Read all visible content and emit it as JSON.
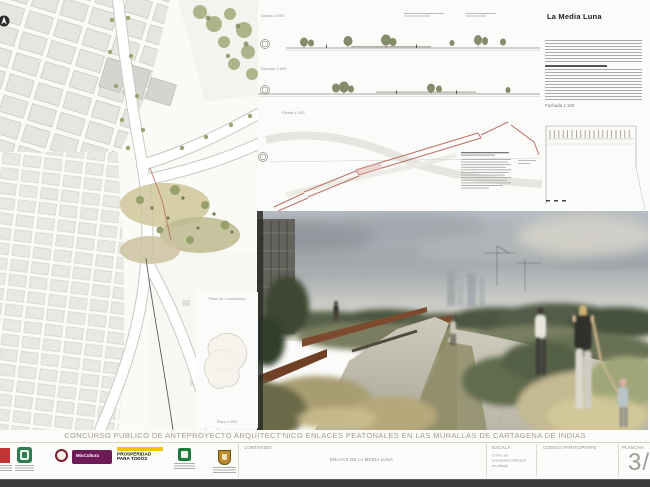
{
  "board": {
    "title": "CONCURSO PUBLICO DE ANTEPROYECTO ARQUITECT'NICO ENLACES PEATONALES EN LAS MURALLAS DE CARTAGENA DE INDIAS"
  },
  "memoria": {
    "heading": "La Media Luna",
    "drawing_label": "Fachada 1:100"
  },
  "drawings": {
    "section_top_label": "Alzado 1:500",
    "section_bottom_label": "Seccion 1:500",
    "axon_label": "Planta 1:200"
  },
  "localization": {
    "title": "Plano de Localizacion",
    "scale": "Plano 1:500"
  },
  "info_bar": {
    "contenido_label": "CONTENIDO",
    "contenido_value": "ENLACE DE LA MEDIA LUNA",
    "escala_label": "ESCALA",
    "escala_value_line1": "Como se",
    "escala_value_line2": "encuentra indicado",
    "escala_value_line3": "en dibujo",
    "codigo_label": "CODIGO PARTICIPANTE",
    "plancha_label": "PLANCHA",
    "plancha_value": "3/6",
    "logos": {
      "mincultura_text": "MinCultura",
      "prosperidad_line1": "PROSPERIDAD",
      "prosperidad_line2": "PARA TODOS"
    }
  },
  "colors": {
    "mincultura_purple": "#6d1a57",
    "prosperidad_yellow": "#f2c500",
    "seal_maroon": "#7a2030",
    "logo_green": "#2e7d4f",
    "corten_rust": "#7d4a2e",
    "diagram_pink": "#bd7068"
  }
}
